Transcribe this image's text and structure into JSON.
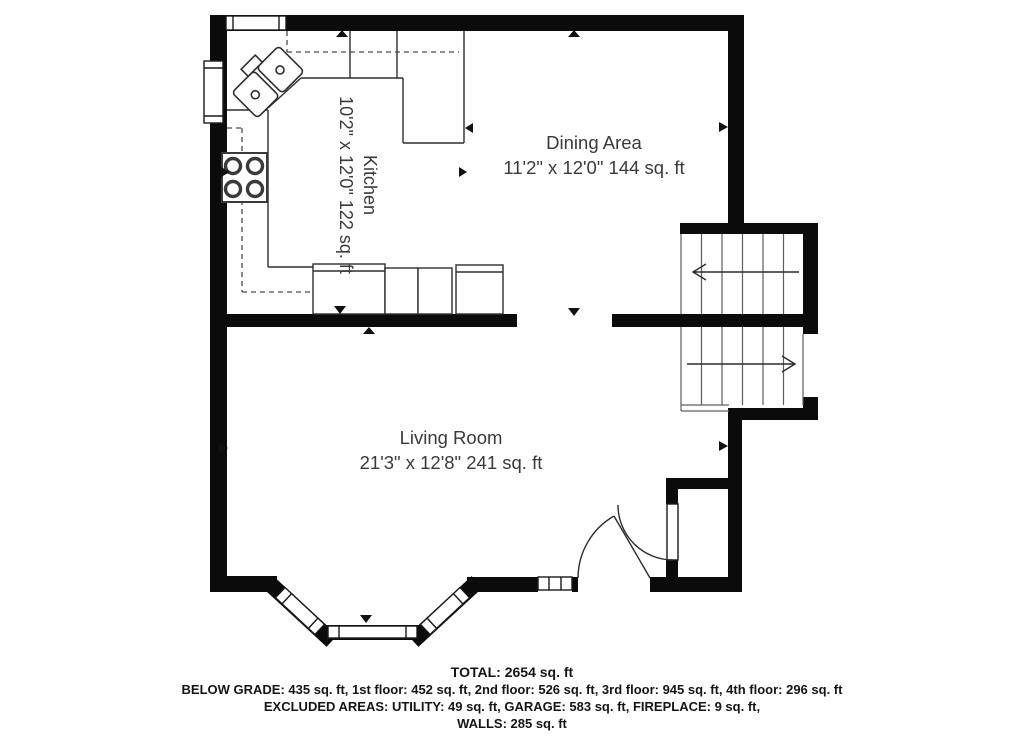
{
  "floorplan": {
    "rooms": [
      {
        "name": "Kitchen",
        "dims": "10'2\" x 12'0\" 122 sq. ft"
      },
      {
        "name": "Dining Area",
        "dims": "11'2\" x 12'0\" 144 sq. ft"
      },
      {
        "name": "Living Room",
        "dims": "21'3\" x 12'8\" 241 sq. ft"
      }
    ],
    "summary": {
      "total": "TOTAL: 2654 sq. ft",
      "floors": "BELOW GRADE: 435 sq. ft, 1st floor: 452 sq. ft, 2nd floor: 526 sq. ft, 3rd floor: 945 sq. ft, 4th floor: 296 sq. ft",
      "excluded": "EXCLUDED AREAS: UTILITY: 49 sq. ft, GARAGE: 583 sq. ft, FIREPLACE: 9 sq. ft,",
      "walls": "WALLS: 285 sq. ft"
    },
    "colors": {
      "wall": "#0b0b0b",
      "background": "#ffffff",
      "line": "#3a3a3a",
      "text": "#3a3a3a"
    }
  }
}
